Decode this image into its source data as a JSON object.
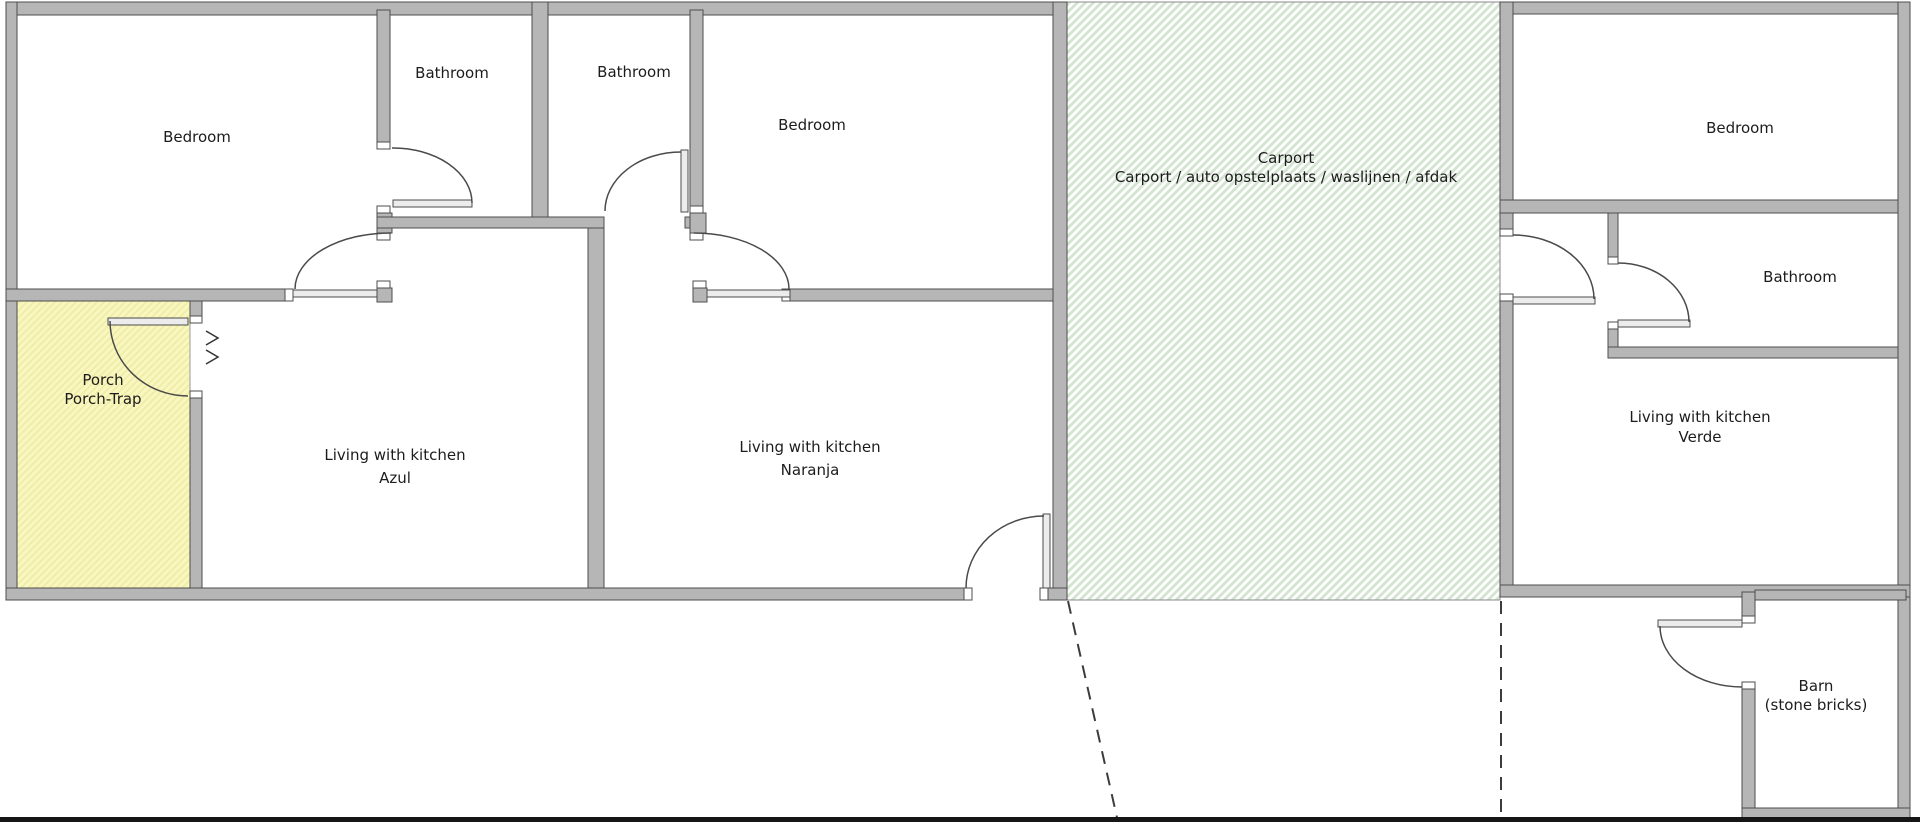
{
  "title": "Floor plan",
  "colors": {
    "wall": "#b6b6b6",
    "wall_edge": "#4d4d4d",
    "porch": "#f9f7bf",
    "porch_hatch": "#efeca4",
    "carport_hatch": "#d3e4d0",
    "text": "#1c1c1c",
    "dashed_line": "#3c3c3c",
    "bottom_border": "#161616"
  },
  "rooms": {
    "bedroom1": {
      "label": "Bedroom"
    },
    "bathroom1": {
      "label": "Bathroom"
    },
    "bathroom2": {
      "label": "Bathroom"
    },
    "bedroom2": {
      "label": "Bedroom"
    },
    "porch": {
      "line1": "Porch",
      "line2": "Porch-Trap"
    },
    "azul": {
      "line1": "Living with kitchen",
      "line2": "Azul"
    },
    "naranja": {
      "line1": "Living with kitchen",
      "line2": "Naranja"
    },
    "carport": {
      "line1": "Carport",
      "line2": "Carport / auto opstelplaats / waslijnen / afdak"
    },
    "bedroom3": {
      "label": "Bedroom"
    },
    "bathroom3": {
      "label": "Bathroom"
    },
    "verde": {
      "line1": "Living with kitchen",
      "line2": "Verde"
    },
    "barn": {
      "line1": "Barn",
      "line2": "(stone bricks)"
    }
  }
}
